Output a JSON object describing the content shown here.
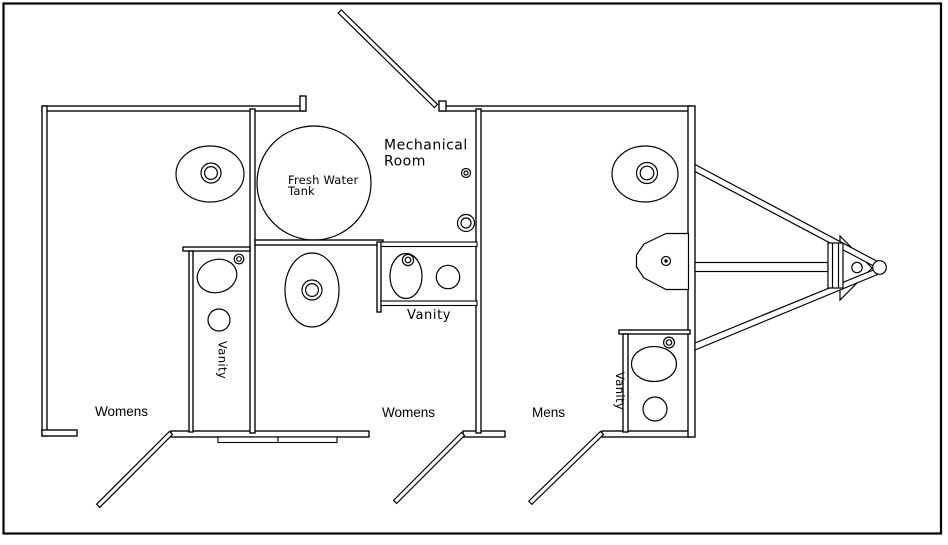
{
  "labels": {
    "mechanical_line1": "Mechanical",
    "mechanical_line2": "Room",
    "tank_line1": "Fresh Water",
    "tank_line2": "Tank",
    "vanity_womens_left": "Vanity",
    "vanity_womens_center": "Vanity",
    "vanity_mens": "Vanity",
    "room_womens_left": "Womens",
    "room_womens_center": "Womens",
    "room_mens": "Mens"
  },
  "colors": {
    "line": "#000000",
    "background": "#ffffff"
  },
  "fixtures": [
    "toilet",
    "oval-sink",
    "fresh-water-tank",
    "urinal",
    "vanity-counter",
    "door-leaf",
    "entry-step",
    "trailer-tongue",
    "hitch-coupler",
    "floor-drain"
  ]
}
